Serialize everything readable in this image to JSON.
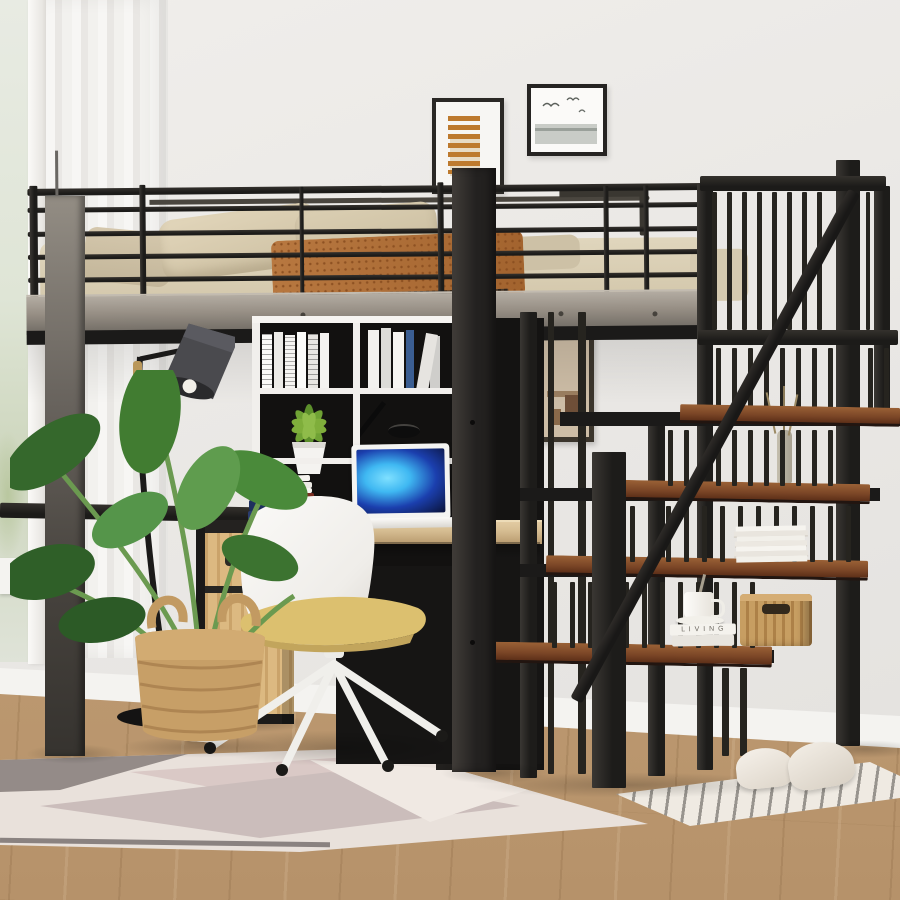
{
  "scene": {
    "type": "furniture-product-photo",
    "subject": "Black metal loft bed with built-in desk, bookcase and storage staircase",
    "setting": "Bright bedroom: white walls, sheer curtain window, light wood floor"
  },
  "text": {
    "book_spine": "L I V I N G"
  },
  "palette": {
    "wall": "#ebe9e6",
    "floor_wood": "#c2a078",
    "metal_black": "#1c1b19",
    "beam_gray": "#8f8a82",
    "stair_tread_wood": "#7a4526",
    "bedding_beige": "#d7ccb2",
    "throw_rust": "#b0713a",
    "desk_wood": "#d6bd92",
    "cabinet_oak": "#d9b47c",
    "chair_white": "#f6f5f2",
    "cushion_yellow": "#dcbf70",
    "plant_green": "#417a33",
    "basket_wicker": "#c79f67",
    "rug_cream": "#e9e1db",
    "curtain_white": "#f5f4f2",
    "laptop_screen_blue": "#3fb8f2"
  },
  "objects": [
    "window with sheer curtain",
    "framed abstract stroke art",
    "framed bird sketch",
    "framed interior photo",
    "loft bed guard rail",
    "mattress with beige bedding",
    "two beige pillows",
    "rust patterned throw with fringe",
    "white cube bookcase",
    "white spine books",
    "succulent in white pot",
    "black desk lamp",
    "wood desk",
    "white laptop with blue screen",
    "stack of desk books",
    "white swivel chair with yellow cushion",
    "oak cabinet with drawer",
    "black floor lamp",
    "monstera plant in wicker basket",
    "storage staircase with wood treads",
    "white magazine stack",
    "coffee cup on books",
    "rattan storage basket",
    "dried stem vase",
    "geometric area rug",
    "striped runner rug",
    "white slippers"
  ]
}
